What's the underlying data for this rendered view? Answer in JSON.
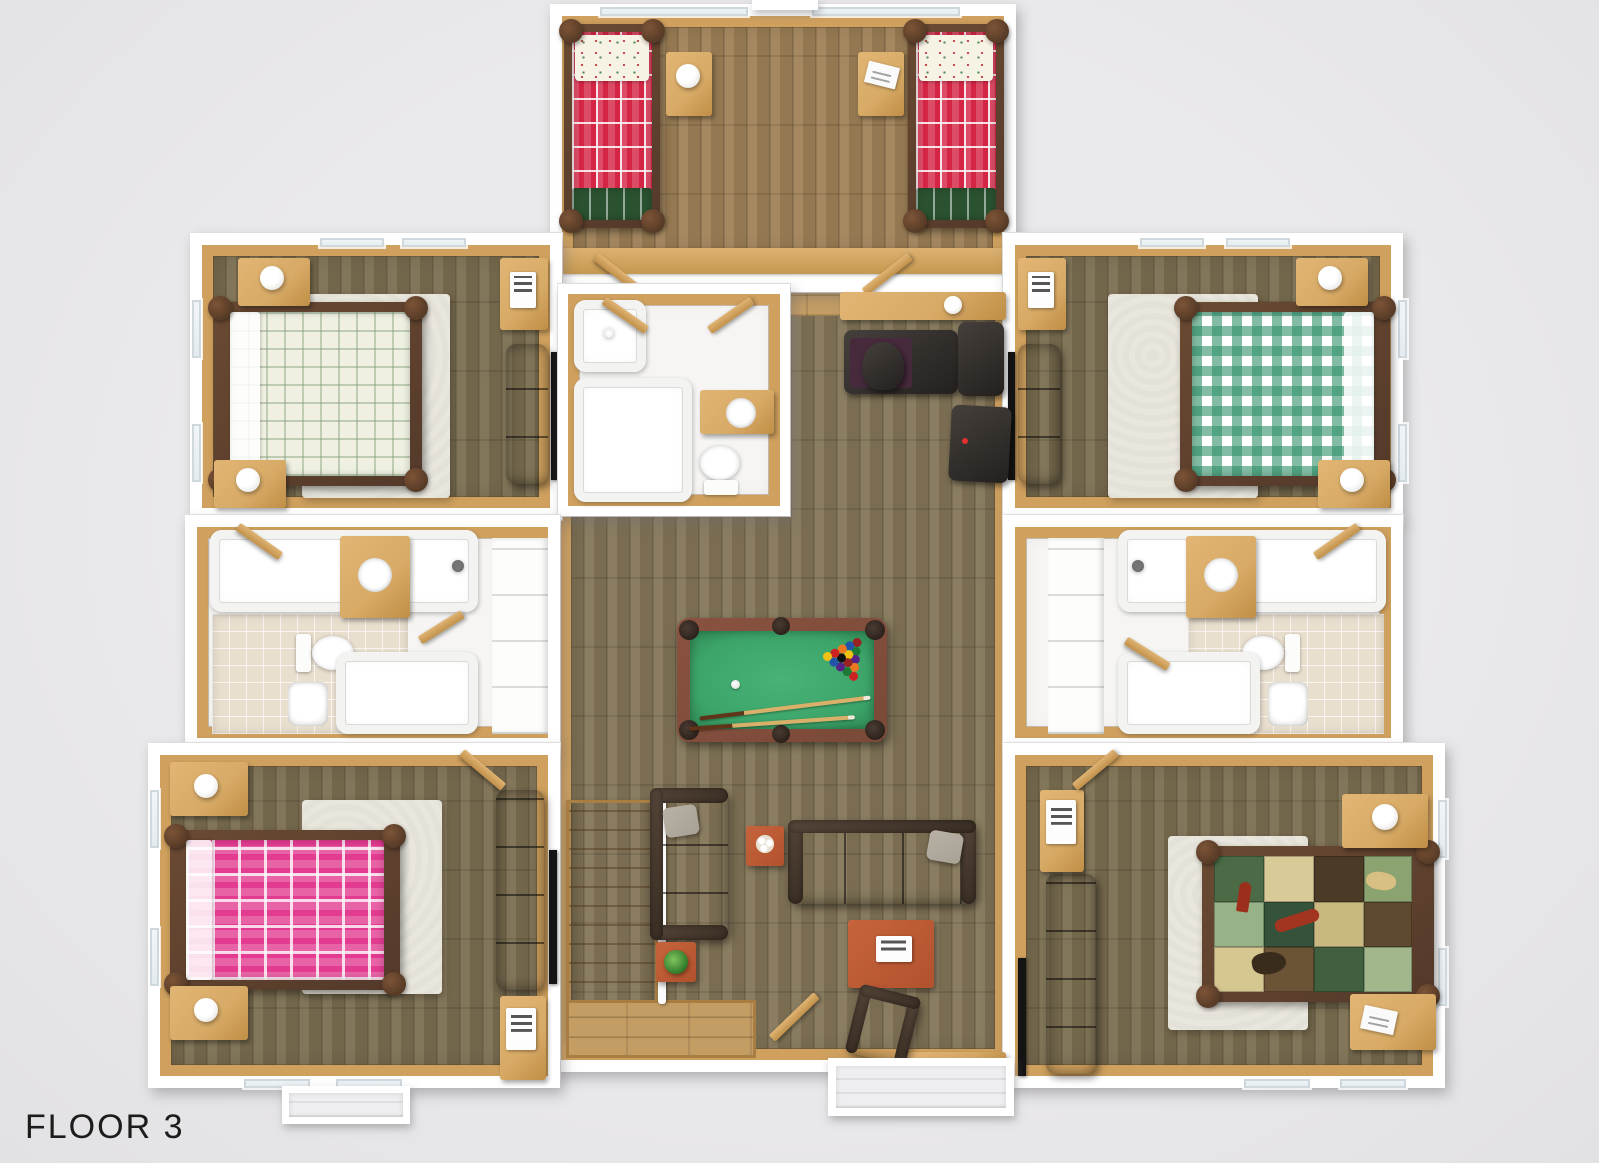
{
  "title": {
    "floor_label": "FLOOR 3"
  },
  "palette": {
    "bg": "#eae9eb",
    "wall": "#ffffff",
    "wood_trim": "#cfa05e",
    "pine": "#d7aa66",
    "log": "#54392a",
    "floor_great": "#847659",
    "floor_bed": "#7c6f51",
    "floor_bunk": "#a08258",
    "floor_hall": "#c49d64",
    "red_plaid": "#d42545",
    "green_blanket": "#2a5230",
    "pink_plaid": "#e23b90",
    "gingham": "#2f9068",
    "cream": "#eff0e2",
    "felt": "#3ca468",
    "pool_frame": "#7a4938",
    "sofa": "#382e27",
    "pillow": "#a8a196",
    "rug": "#e9e6dd",
    "accent": "#b2522d",
    "tile": "#e9dfcf",
    "tv": "#141414",
    "label": "#1c1c1c"
  },
  "rooms": [
    {
      "name": "bunk room (top center)",
      "contents": [
        "twin log bed, red plaid bedding, green plaid foot blanket",
        "twin log bed, red plaid bedding, green plaid foot blanket",
        "nightstand with lamp",
        "nightstand with magazine",
        "windows on north wall"
      ]
    },
    {
      "name": "bedroom northwest",
      "contents": [
        "log queen bed with white-green plaid bedding",
        "white area rug",
        "two nightstands with lamps",
        "dresser with info plaque",
        "loveseat",
        "wall tv"
      ]
    },
    {
      "name": "bedroom northeast",
      "contents": [
        "log queen bed with green gingham bedding",
        "white area rug",
        "two nightstands with lamps",
        "dresser with info plaque",
        "loveseat",
        "wall tv"
      ]
    },
    {
      "name": "bedroom southwest",
      "contents": [
        "log queen bed with pink plaid bedding",
        "white area rug",
        "two nightstands with lamps",
        "loveseat",
        "cabinet with info plaque",
        "wall tv"
      ]
    },
    {
      "name": "bedroom southeast",
      "contents": [
        "log queen bed with lodge patchwork quilt",
        "white area rug",
        "two nightstands",
        "loveseat",
        "cabinet with info plaque",
        "wall tv"
      ]
    },
    {
      "name": "great room (center)",
      "contents": [
        "pool table with racked balls, cue ball and two cues",
        "two dark leather sofas with gray pillows",
        "leather armchair",
        "small accent table with flowers",
        "large coffee table with game box",
        "side table with plant",
        "staircase with landing",
        "balcony door"
      ]
    },
    {
      "name": "office nook",
      "contents": [
        "desk counter with cup",
        "desk with office chair",
        "two dark cabinets"
      ]
    },
    {
      "name": "center bathroom",
      "contents": [
        "shower",
        "bathtub",
        "toilet",
        "vanity sink"
      ]
    },
    {
      "name": "west bathrooms",
      "contents": [
        "bathtub",
        "tile floor",
        "toilet",
        "wood vanity with sink",
        "second bathtub",
        "sink",
        "linen closet"
      ]
    },
    {
      "name": "east bathrooms",
      "contents": [
        "bathtub",
        "tile floor",
        "toilet",
        "wood vanity with sink",
        "second bathtub",
        "sink",
        "linen closet"
      ]
    }
  ]
}
